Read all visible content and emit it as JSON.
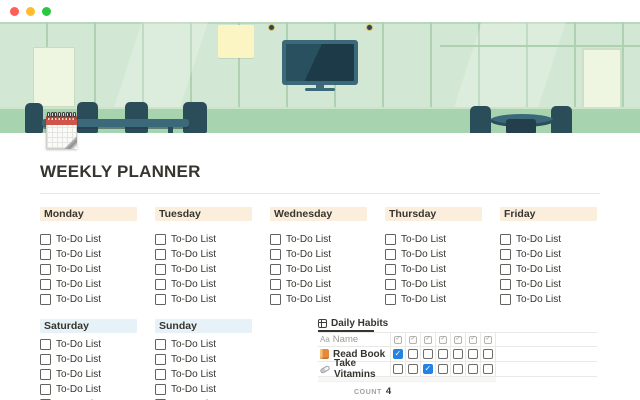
{
  "window": {
    "controls": [
      {
        "name": "close",
        "color": "#ff5f57"
      },
      {
        "name": "minimize",
        "color": "#febc2e"
      },
      {
        "name": "maximize",
        "color": "#28c840"
      }
    ]
  },
  "page": {
    "title": "WEEKLY PLANNER",
    "icon": "tear-off-calendar"
  },
  "planner": {
    "todo_label": "To-Do List",
    "todos_per_day": 5,
    "weekday_rows": [
      {
        "days": [
          "Monday",
          "Tuesday",
          "Wednesday",
          "Thursday",
          "Friday"
        ],
        "header_bg": "#fbeedc"
      },
      {
        "days": [
          "Saturday",
          "Sunday"
        ],
        "header_bg": "#e7f2f8"
      }
    ]
  },
  "habits": {
    "tab_label": "Daily Habits",
    "tab_icon": "table-view-icon",
    "columns": {
      "type_icon": "Aa",
      "name_header": "Name",
      "check_column_count": 7,
      "check_column_icon": "checkbox-icon"
    },
    "rows": [
      {
        "icon": "orange-book-emoji",
        "name": "Read Book",
        "checks": [
          true,
          false,
          false,
          false,
          false,
          false,
          false
        ]
      },
      {
        "icon": "pill-emoji",
        "name": "Take Vitamins",
        "checks": [
          false,
          false,
          true,
          false,
          false,
          false,
          false
        ]
      }
    ],
    "footer": {
      "label": "COUNT",
      "value": "4"
    }
  },
  "colors": {
    "accent_checked": "#2383e2",
    "text": "#37352f",
    "muted_text": "#9b9a97",
    "table_border": "#e9e9e7",
    "cover_wall": "#d3e8d4",
    "cover_wall_line": "#aed2b1",
    "cover_floor_band": "#a7d3af",
    "cover_furniture": "#2b4c59",
    "cover_furniture_light": "#3c6979",
    "cover_poster_yellow": "#fbf5c3",
    "cover_board": "#eef5e0"
  }
}
